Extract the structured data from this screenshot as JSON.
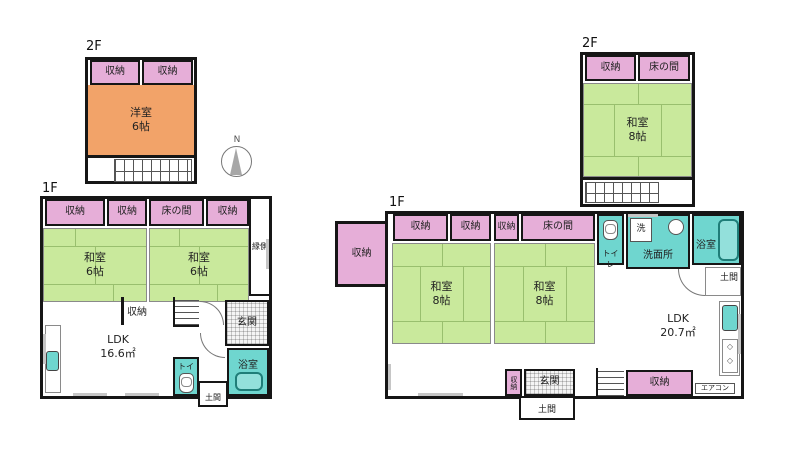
{
  "colors": {
    "storage_pink": "#e6aed8",
    "tatami_green": "#c9e99c",
    "western_orange": "#f2a369",
    "wet_teal": "#6fd6cf"
  },
  "compass": {
    "label": "N"
  },
  "left_building": {
    "floor2": {
      "floor_label": "2F",
      "closets": [
        "収納",
        "収納"
      ],
      "room": {
        "name": "洋室",
        "size": "6帖"
      }
    },
    "floor1": {
      "floor_label": "1F",
      "top_row": [
        "収納",
        "収納",
        "床の間",
        "収納"
      ],
      "rooms": [
        {
          "name": "和室",
          "size": "6帖"
        },
        {
          "name": "和室",
          "size": "6帖"
        }
      ],
      "engawa": "縁側",
      "closet": "収納",
      "ldk": {
        "name": "LDK",
        "size": "16.6㎡"
      },
      "entrance": "玄関",
      "toilet": "トイレ",
      "bath": "浴室",
      "doma": "土間"
    }
  },
  "right_building": {
    "floor2": {
      "floor_label": "2F",
      "closet": "収納",
      "tokonoma": "床の間",
      "room": {
        "name": "和室",
        "size": "8帖"
      }
    },
    "floor1": {
      "floor_label": "1F",
      "detached_closet": "収納",
      "top_row": [
        "収納",
        "収納",
        "収納",
        "床の間"
      ],
      "rooms": [
        {
          "name": "和室",
          "size": "8帖"
        },
        {
          "name": "和室",
          "size": "8帖"
        }
      ],
      "toilet": "トイレ",
      "laundry": "洗",
      "washroom": "洗面所",
      "bath": "浴室",
      "doma_right": "土間",
      "ldk": {
        "name": "LDK",
        "size": "20.7㎡"
      },
      "aircon": "エアコン",
      "closet_bottom": "収納",
      "closet_vertical": "収納",
      "entrance": "玄関",
      "doma_bottom": "土間"
    }
  }
}
